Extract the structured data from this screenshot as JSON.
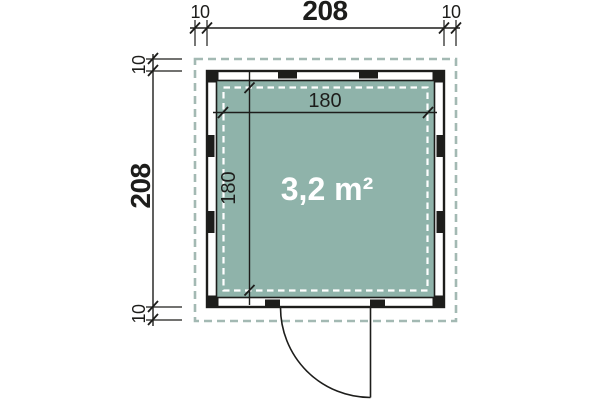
{
  "colors": {
    "floor_fill": "#8FB3AA",
    "roof_dash": "#A3B9B3",
    "inner_dash": "#FFFFFF",
    "line": "#1D1D1B"
  },
  "dimensions": {
    "overall_width": "208",
    "overall_depth": "208",
    "overhang_left": "10",
    "overhang_right": "10",
    "overhang_top": "10",
    "overhang_bottom": "10",
    "interior_width": "180",
    "interior_depth": "180"
  },
  "labels": {
    "area": "3,2 m²"
  }
}
